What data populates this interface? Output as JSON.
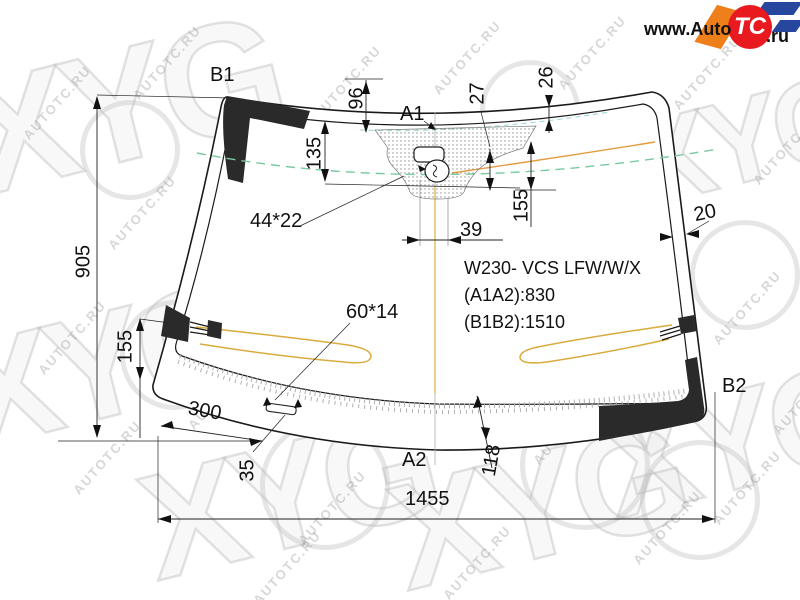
{
  "logo": {
    "prefix": "www.Auto",
    "badge": "TC",
    "suffix": ".ru"
  },
  "watermark": {
    "text": "AUTOTC.RU",
    "brand": "XYG"
  },
  "part": {
    "model": "W230- VCS LFW/W/X",
    "a1a2": "(A1A2):830",
    "b1b2": "(B1B2):1510"
  },
  "points": {
    "a1": "A1",
    "a2": "A2",
    "b1": "B1",
    "b2": "B2"
  },
  "dims": {
    "d96": "96",
    "d135": "135",
    "d27": "27",
    "d26": "26",
    "d155_center": "155",
    "d39": "39",
    "d44x22": "44*22",
    "d60x14": "60*14",
    "d20": "20",
    "d905": "905",
    "d155_left": "155",
    "d300": "300",
    "d35": "35",
    "d118": "118",
    "d1455": "1455"
  },
  "colors": {
    "drawing_line": "#1a1a1a",
    "black_band": "#2a2a2a",
    "heater_wire": "#d9ab3c",
    "antenna_line": "#e39b3d",
    "shade_band_dashed": "#79c9a1",
    "teal_dashed": "#7fd0c8",
    "logo_red": "#e8191f",
    "logo_orange": "#ef7f1b",
    "logo_blue": "#27479e"
  }
}
